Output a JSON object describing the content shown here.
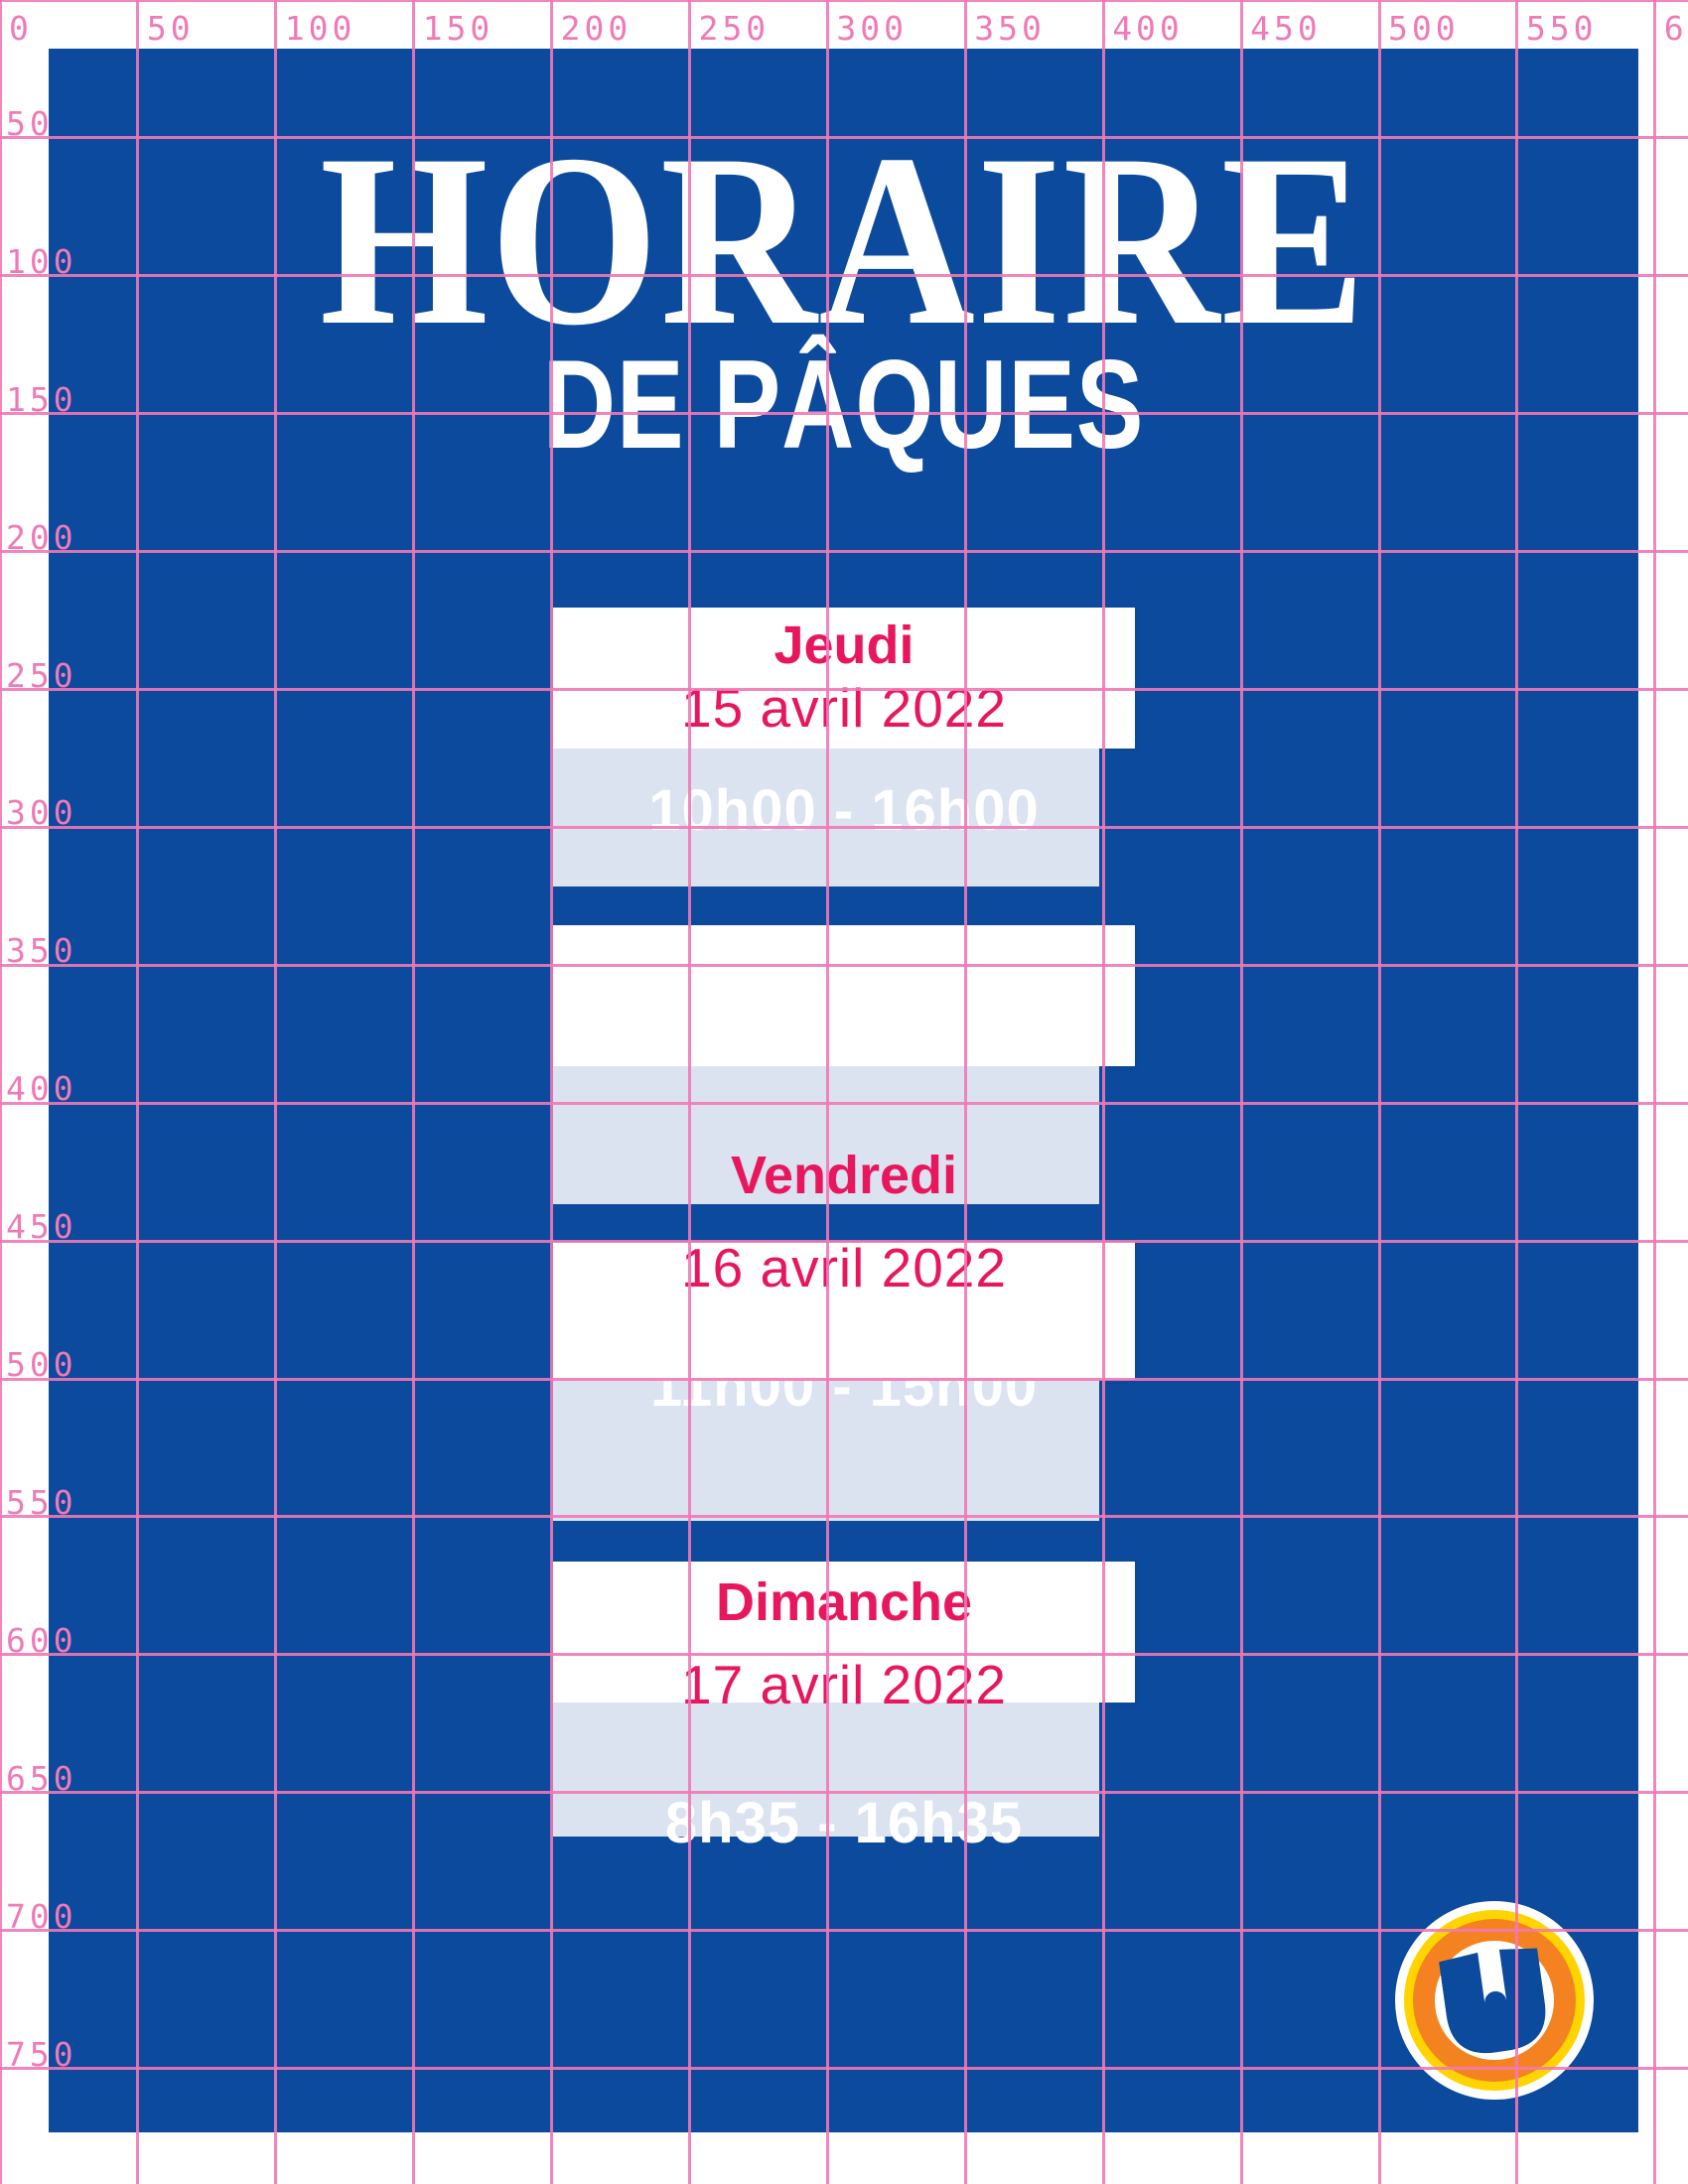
{
  "poster": {
    "title": "HORAIRE",
    "subtitle": "DE PÂQUES"
  },
  "schedule": [
    {
      "day": "Jeudi",
      "date": "15 avril 2022",
      "hours": "10h00 - 16h00"
    },
    {
      "day": "Vendredi",
      "date": "16 avril 2022",
      "hours": "11h00 - 15h00"
    },
    {
      "day": "Dimanche",
      "date": "17 avril 2022",
      "hours": "8h35 - 16h35"
    }
  ],
  "ruler": {
    "top_labels": [
      "0",
      "50",
      "100",
      "150",
      "200",
      "250",
      "300",
      "350",
      "400",
      "450",
      "500",
      "550",
      "600"
    ],
    "left_labels": [
      "50",
      "100",
      "150",
      "200",
      "250",
      "300",
      "350",
      "400",
      "450",
      "500",
      "550",
      "600",
      "650",
      "700",
      "750"
    ]
  },
  "logo": {
    "letter": "U"
  },
  "colors": {
    "poster_blue": "#0b4a9c",
    "accent_crimson": "#e8175d",
    "band_light_blue": "#dbe3f1",
    "grid_pink": "#f278b6",
    "logo_yellow": "#ffd400",
    "logo_orange": "#f58220"
  }
}
